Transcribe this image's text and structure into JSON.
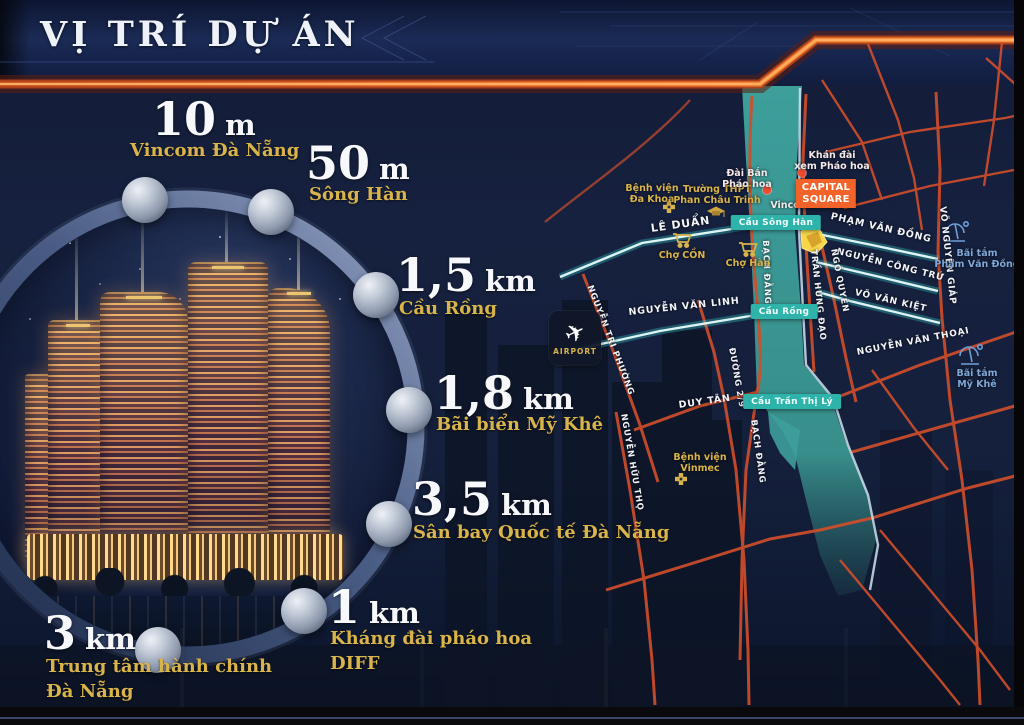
{
  "page": {
    "title": "VỊ TRÍ DỰ ÁN"
  },
  "colors": {
    "gold": "#d9b44a",
    "highway_orange": "#f07a2e",
    "river_teal": "#3d9e9a",
    "bridge_badge": "#2db3a9",
    "capital_badge": "#f2632a"
  },
  "distances": [
    {
      "value": "10",
      "unit": "m",
      "place": "Vincom Đà Nẵng"
    },
    {
      "value": "50",
      "unit": "m",
      "place": "Sông Hàn"
    },
    {
      "value": "1,5",
      "unit": "km",
      "place": "Cầu Rồng"
    },
    {
      "value": "1,8",
      "unit": "km",
      "place": "Bãi biển Mỹ Khê"
    },
    {
      "value": "3,5",
      "unit": "km",
      "place": "Sân bay Quốc tế Đà Nẵng"
    },
    {
      "value": "1",
      "unit": "km",
      "place": "Kháng đài pháo hoa",
      "place2": "DIFF"
    },
    {
      "value": "3",
      "unit": "km",
      "place": "Trung tâm hành chính",
      "place2": "Đà Nẵng"
    }
  ],
  "map": {
    "airport_label": "AIRPORT",
    "streets": [
      {
        "label": "LÊ DUẨN"
      },
      {
        "label": "NGUYỄN VĂN LINH"
      },
      {
        "label": "DUY TÂN"
      },
      {
        "label": "PHẠM VĂN ĐỒNG"
      },
      {
        "label": "NGUYỄN CÔNG TRỨ"
      },
      {
        "label": "VÕ VĂN KIỆT"
      },
      {
        "label": "VÕ NGUYÊN GIÁP"
      },
      {
        "label": "NGÔ QUYỀN"
      },
      {
        "label": "BẠCH ĐẰNG"
      },
      {
        "label": "TRẦN HƯNG ĐẠO"
      },
      {
        "label": "NGUYỄN TRI PHƯỜNG"
      },
      {
        "label": "NGUYỄN HỮU THỌ"
      },
      {
        "label": "ĐƯỜNG 2/9"
      },
      {
        "label": "NGUYỄN VĂN THOẠI"
      },
      {
        "label": "BẠCH ĐẰNG"
      }
    ],
    "bridges": [
      {
        "label": "Cầu Sông Hàn"
      },
      {
        "label": "Cầu Rồng"
      },
      {
        "label": "Cầu Trần Thị Lý"
      }
    ],
    "pois": [
      {
        "line1": "Bệnh viện",
        "line2": "Đa Khoa"
      },
      {
        "line1": "Trường THPT",
        "line2": "Phan Châu Trinh"
      },
      {
        "line1": "Chợ CỒN"
      },
      {
        "line1": "Chợ Hàn"
      },
      {
        "line1": "Đài Bắn",
        "line2": "Pháo hoa"
      },
      {
        "line1": "Khán đài",
        "line2": "xem Pháo hoa"
      },
      {
        "line1": "Vincom"
      },
      {
        "line1": "CAPITAL",
        "line2": "SQUARE"
      },
      {
        "line1": "Bệnh viện",
        "line2": "Vinmec"
      },
      {
        "line1": "Bãi tắm",
        "line2": "Phạm Văn Đồng"
      },
      {
        "line1": "Bãi tắm",
        "line2": "Mỹ Khê"
      }
    ]
  }
}
